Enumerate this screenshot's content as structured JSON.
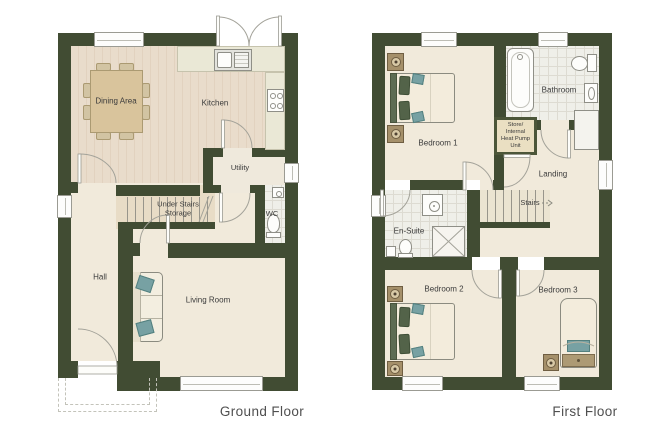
{
  "colors": {
    "wall": "#414c33",
    "cream": "#f1eadb",
    "wood": "#e9dccb",
    "wood_stripe": "#e2d2bf",
    "tan": "#e8dcc6",
    "tile": "#efefe9",
    "tile_line": "#dddbd2",
    "counter": "#eae8d6",
    "table": "#d9c49c",
    "chair": "#d2c4a3",
    "teal": "#77a1a3",
    "headboard": "#5d6c53",
    "pillow": "#536349",
    "wood_furniture": "#a5906a",
    "lamp": "#d8c9a6",
    "line": "#8f8f87",
    "label": "#3b3b3b",
    "title": "#4f4f4f",
    "store_bg": "#eadfc2",
    "store_border": "#4c5639"
  },
  "ground_floor": {
    "title": "Ground Floor",
    "labels": {
      "dining": "Dining Area",
      "kitchen": "Kitchen",
      "utility": "Utility",
      "understairs_line1": "Under Stairs",
      "understairs_line2": "Storage",
      "wc": "WC",
      "hall": "Hall",
      "living": "Living Room"
    }
  },
  "first_floor": {
    "title": "First Floor",
    "labels": {
      "bedroom1": "Bedroom 1",
      "bathroom": "Bathroom",
      "store_lines": [
        "Store/",
        "Internal",
        "Heat Pump",
        "Unit"
      ],
      "landing": "Landing",
      "stairs": "Stairs",
      "ensuite": "En-Suite",
      "bedroom2": "Bedroom 2",
      "bedroom3": "Bedroom 3"
    }
  }
}
